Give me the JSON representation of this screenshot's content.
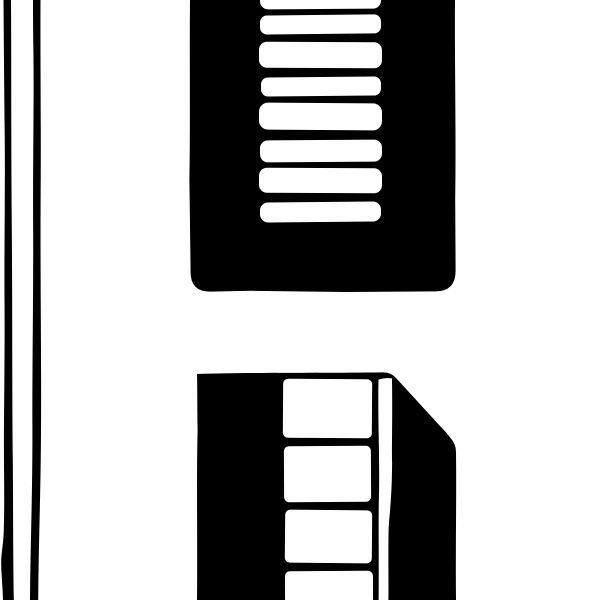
{
  "image": {
    "description": "Black-and-white woodcut-style ink illustration, cropped close-up: two hand-drawn vertical lines along the left edge, a dark louvered shutter window with eight white horizontal slats at the top (cut off by the top edge), and below it a dark paneled door or cabinet drawn in perspective with four white recessed panels, a white vertical edge highlight strip, and a beveled dark side face.",
    "style": "hand-drawn ink / woodcut, pure black on white, no text"
  },
  "palette": {
    "ink": "#000000",
    "paper": "#ffffff"
  },
  "scene": {
    "left_rules": {
      "count": 2,
      "note": "two wobbly vertical black lines running the full image height near the left edge"
    },
    "shutter_window": {
      "slat_count": 8,
      "note": "dark rectangular block, top edge cropped, rounded bottom corners, white horizontal louver slats in the middle column"
    },
    "paneled_door": {
      "panel_count": 4,
      "note": "dark block in perspective, bottom edge cropped; four white panels separated by black divider strokes, a white vertical strip at right of panels, diagonal beveled top-right corner on the dark side face"
    }
  }
}
